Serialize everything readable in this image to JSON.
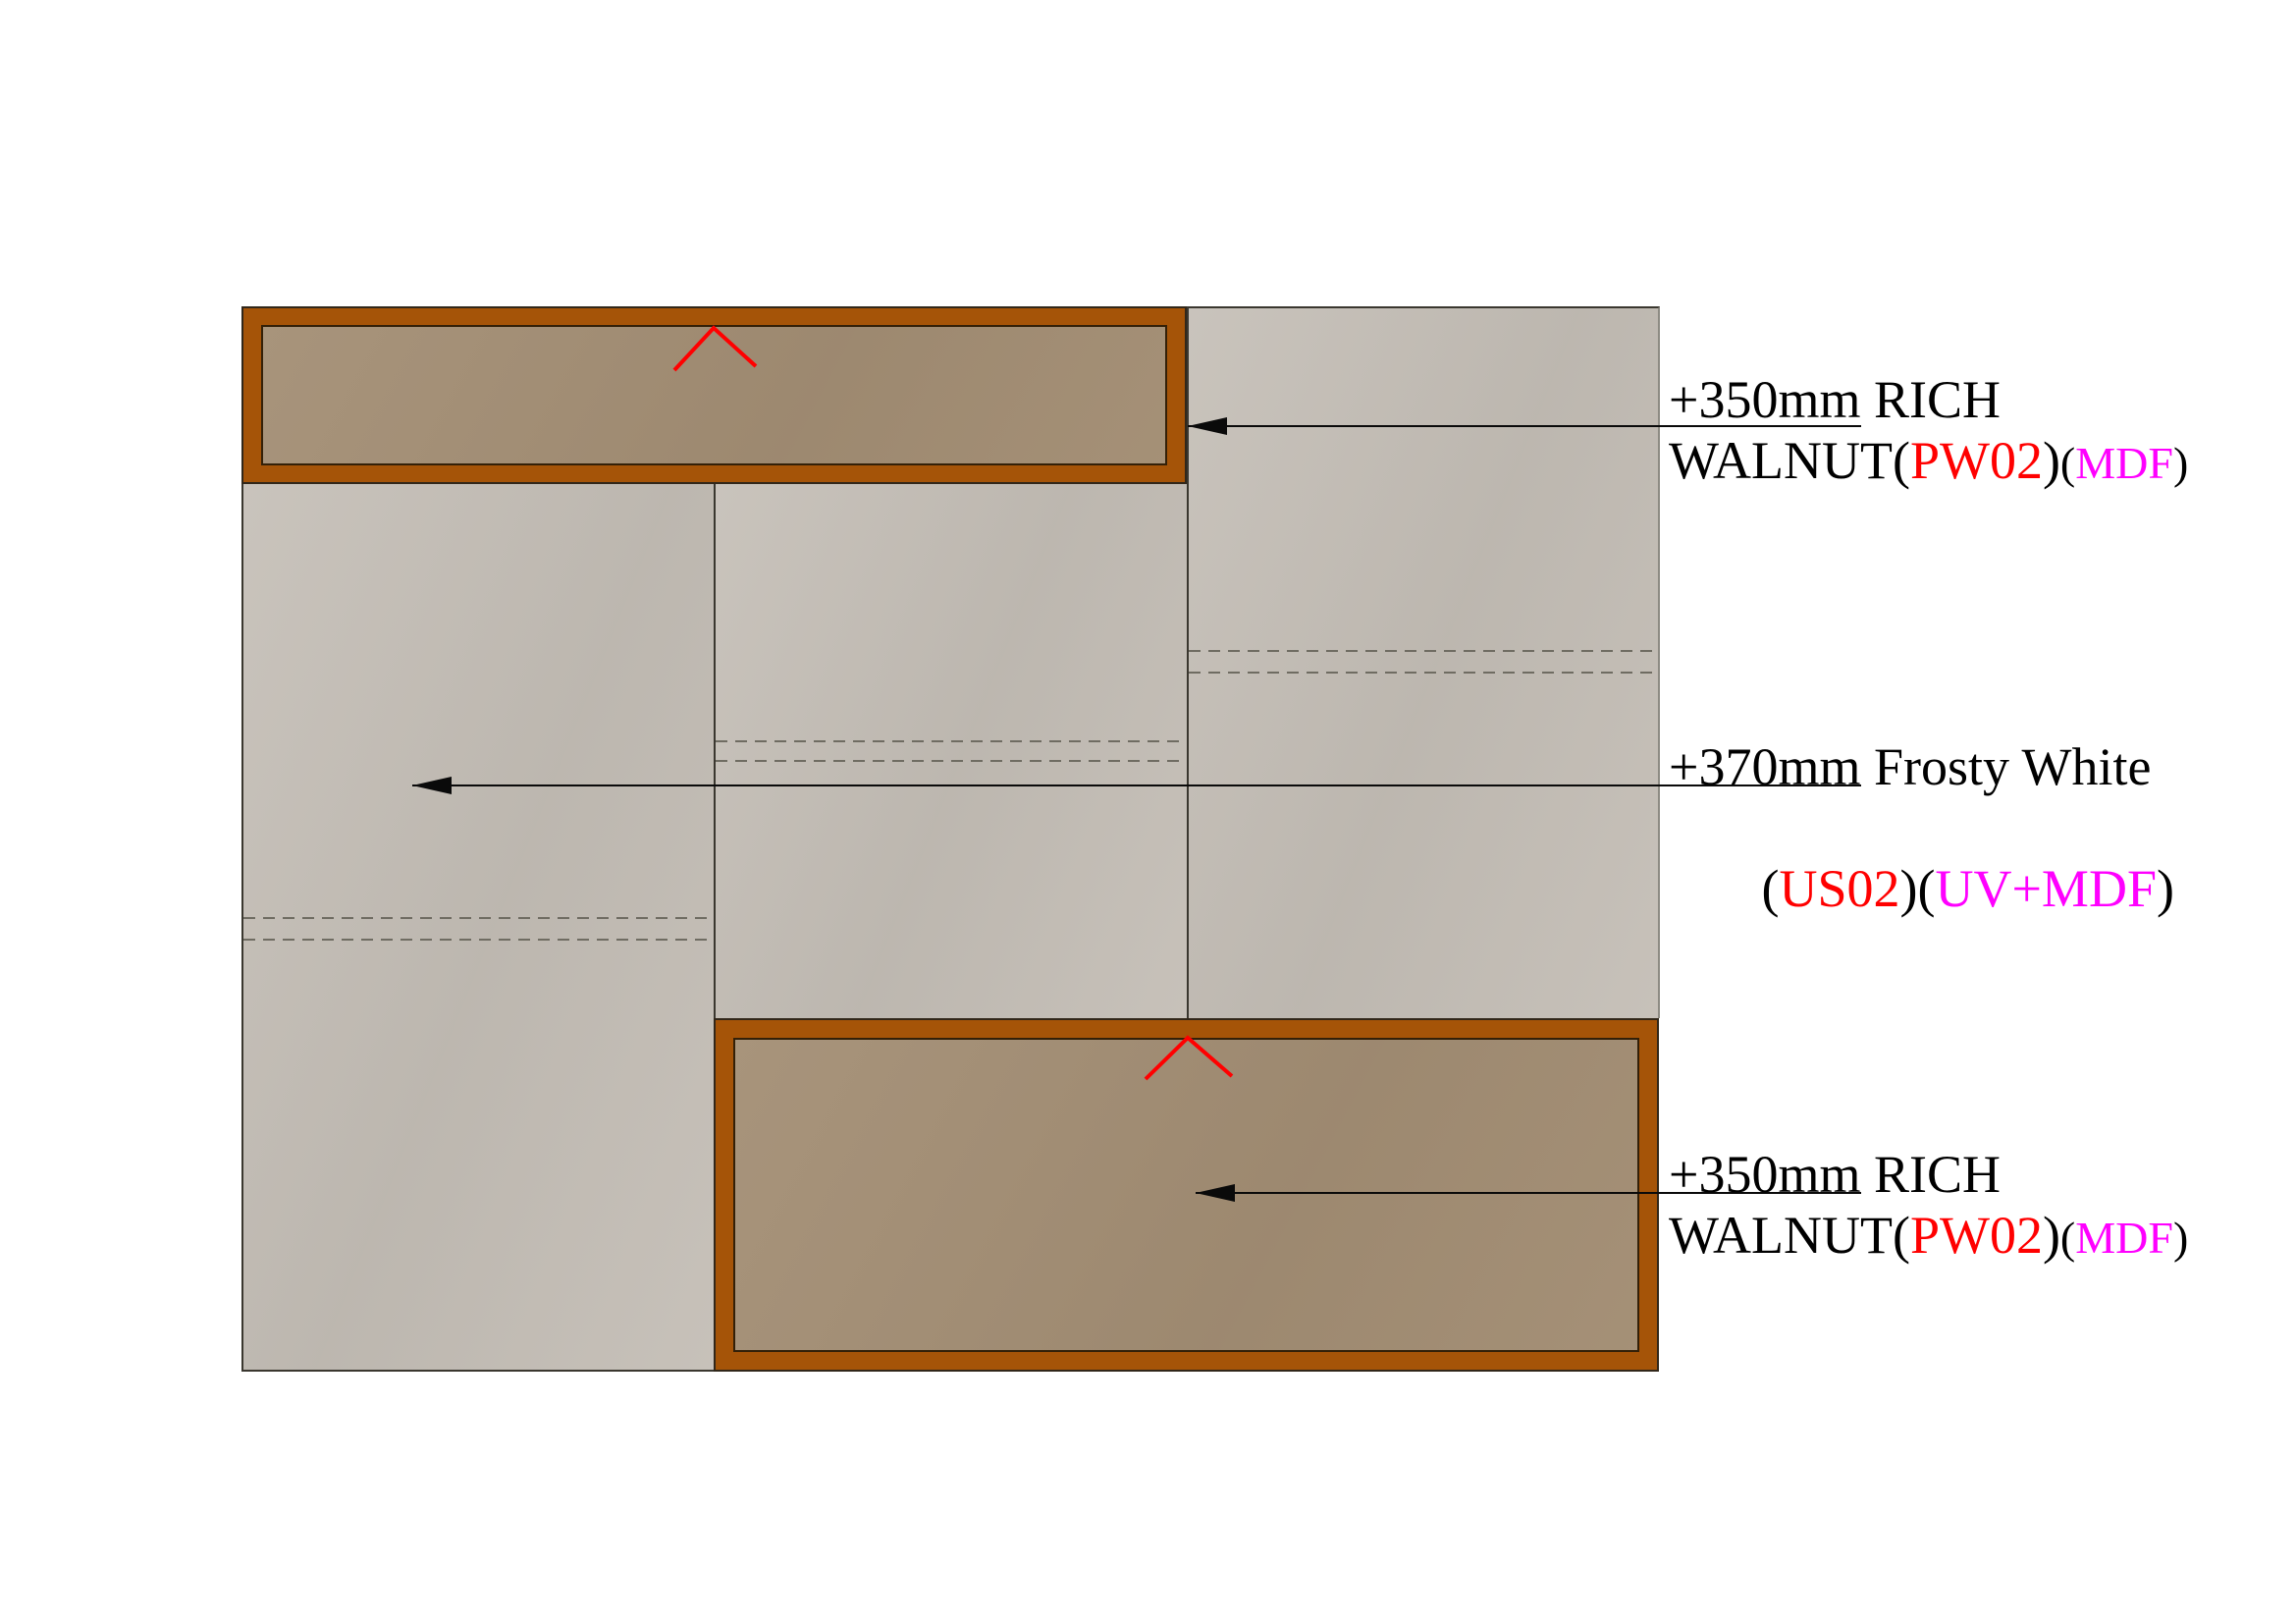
{
  "colors": {
    "frame_brown": "#a55408",
    "board_tan": "#a38e74",
    "panel_gray": "#c5bfb7",
    "outline_dark": "#3a372f",
    "outline_light": "#8d8b83",
    "frame_outline": "#31271a",
    "board_outline": "#332008",
    "dash_gray": "#6f6c62",
    "leader_black": "#0a0a0a",
    "accent_red": "#ff0000",
    "accent_magenta": "#ff00ff",
    "text_black": "#000000"
  },
  "annotations": [
    {
      "id": "top-walnut-shutter",
      "line1": [
        {
          "t": "+350mm RICH",
          "c": "text_black"
        }
      ],
      "line2": [
        {
          "t": "WALNUT(",
          "c": "text_black"
        },
        {
          "t": "PW02",
          "c": "accent_red"
        },
        {
          "t": ")",
          "c": "text_black"
        },
        {
          "t": "(",
          "c": "text_black",
          "small": true
        },
        {
          "t": "MDF",
          "c": "accent_magenta",
          "small": true
        },
        {
          "t": ")",
          "c": "text_black",
          "small": true
        }
      ]
    },
    {
      "id": "frosty-white-carcass",
      "line1": [
        {
          "t": "+370mm Frosty White",
          "c": "text_black"
        }
      ],
      "line2": [
        {
          "t": " (",
          "c": "text_black"
        },
        {
          "t": "US02",
          "c": "accent_red"
        },
        {
          "t": ")(",
          "c": "text_black"
        },
        {
          "t": "UV+MDF",
          "c": "accent_magenta"
        },
        {
          "t": ")",
          "c": "text_black"
        }
      ]
    },
    {
      "id": "bottom-walnut-shutter",
      "line1": [
        {
          "t": "+350mm RICH",
          "c": "text_black"
        }
      ],
      "line2": [
        {
          "t": "WALNUT(",
          "c": "text_black"
        },
        {
          "t": "PW02",
          "c": "accent_red"
        },
        {
          "t": ")",
          "c": "text_black"
        },
        {
          "t": "(",
          "c": "text_black",
          "small": true
        },
        {
          "t": "MDF",
          "c": "accent_magenta",
          "small": true
        },
        {
          "t": ")",
          "c": "text_black",
          "small": true
        }
      ]
    }
  ]
}
